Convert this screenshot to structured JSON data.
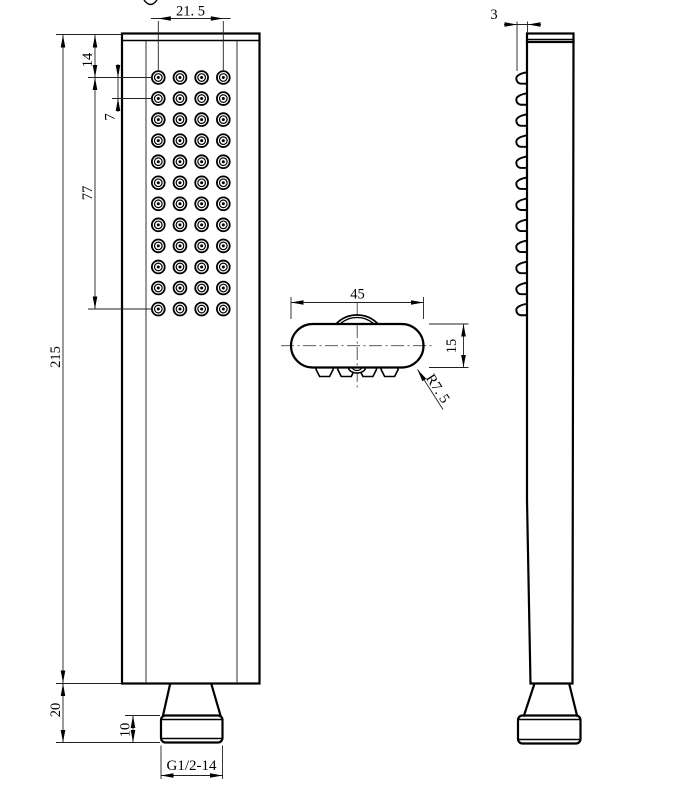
{
  "drawing": {
    "background": "#ffffff",
    "line_color": "#000000",
    "nozzle_grid": {
      "rows": 12,
      "cols": 4
    },
    "dims": {
      "d21_5": "21. 5",
      "d14": "14",
      "d7": "7",
      "d77": "77",
      "d215": "215",
      "d20": "20",
      "d10": "10",
      "thread": "G1/2-14",
      "d45": "45",
      "d15": "15",
      "r7_5": "R7. 5",
      "d3": "3"
    }
  }
}
